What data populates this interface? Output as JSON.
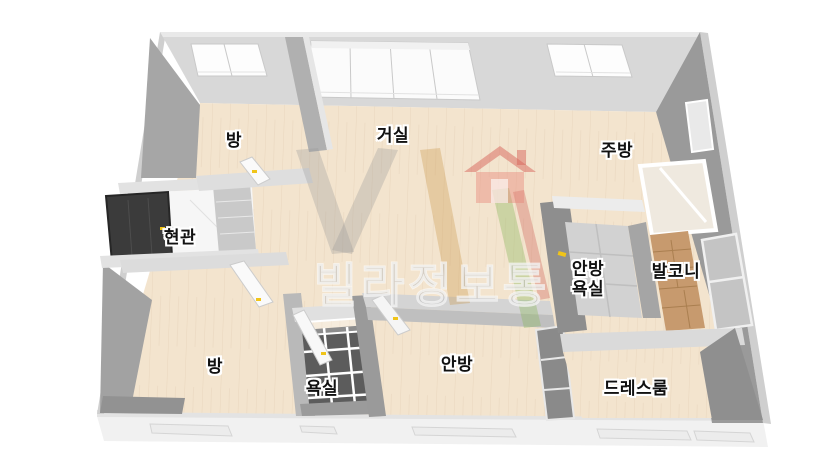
{
  "watermark": {
    "text": "빌라정보통",
    "logo_icon": "house-icon",
    "logo_color": "#e07b70"
  },
  "rooms": [
    {
      "id": "room-top-left",
      "label": "방"
    },
    {
      "id": "living-room",
      "label": "거실"
    },
    {
      "id": "kitchen",
      "label": "주방"
    },
    {
      "id": "entrance",
      "label": "현관"
    },
    {
      "id": "room-bottom-left",
      "label": "방"
    },
    {
      "id": "bathroom",
      "label": "욕실"
    },
    {
      "id": "master-bedroom",
      "label": "안방"
    },
    {
      "id": "master-bathroom",
      "label": "안방\n욕실"
    },
    {
      "id": "balcony",
      "label": "발코니"
    },
    {
      "id": "dress-room",
      "label": "드레스룸"
    }
  ],
  "colors": {
    "floor_wood_cream": "#f3e4ce",
    "wall_light": "#d8d8d8",
    "wall_dark": "#9a9a9a",
    "bath_tile_dark": "#5c5c5c",
    "master_bath_tile": "#d2d2d2",
    "balcony_wood": "#c79a6e",
    "entrance_door": "#3b3b3b",
    "door_handle_yellow": "#f0c419",
    "label_text": "#111111",
    "label_halo": "#ffffff"
  }
}
